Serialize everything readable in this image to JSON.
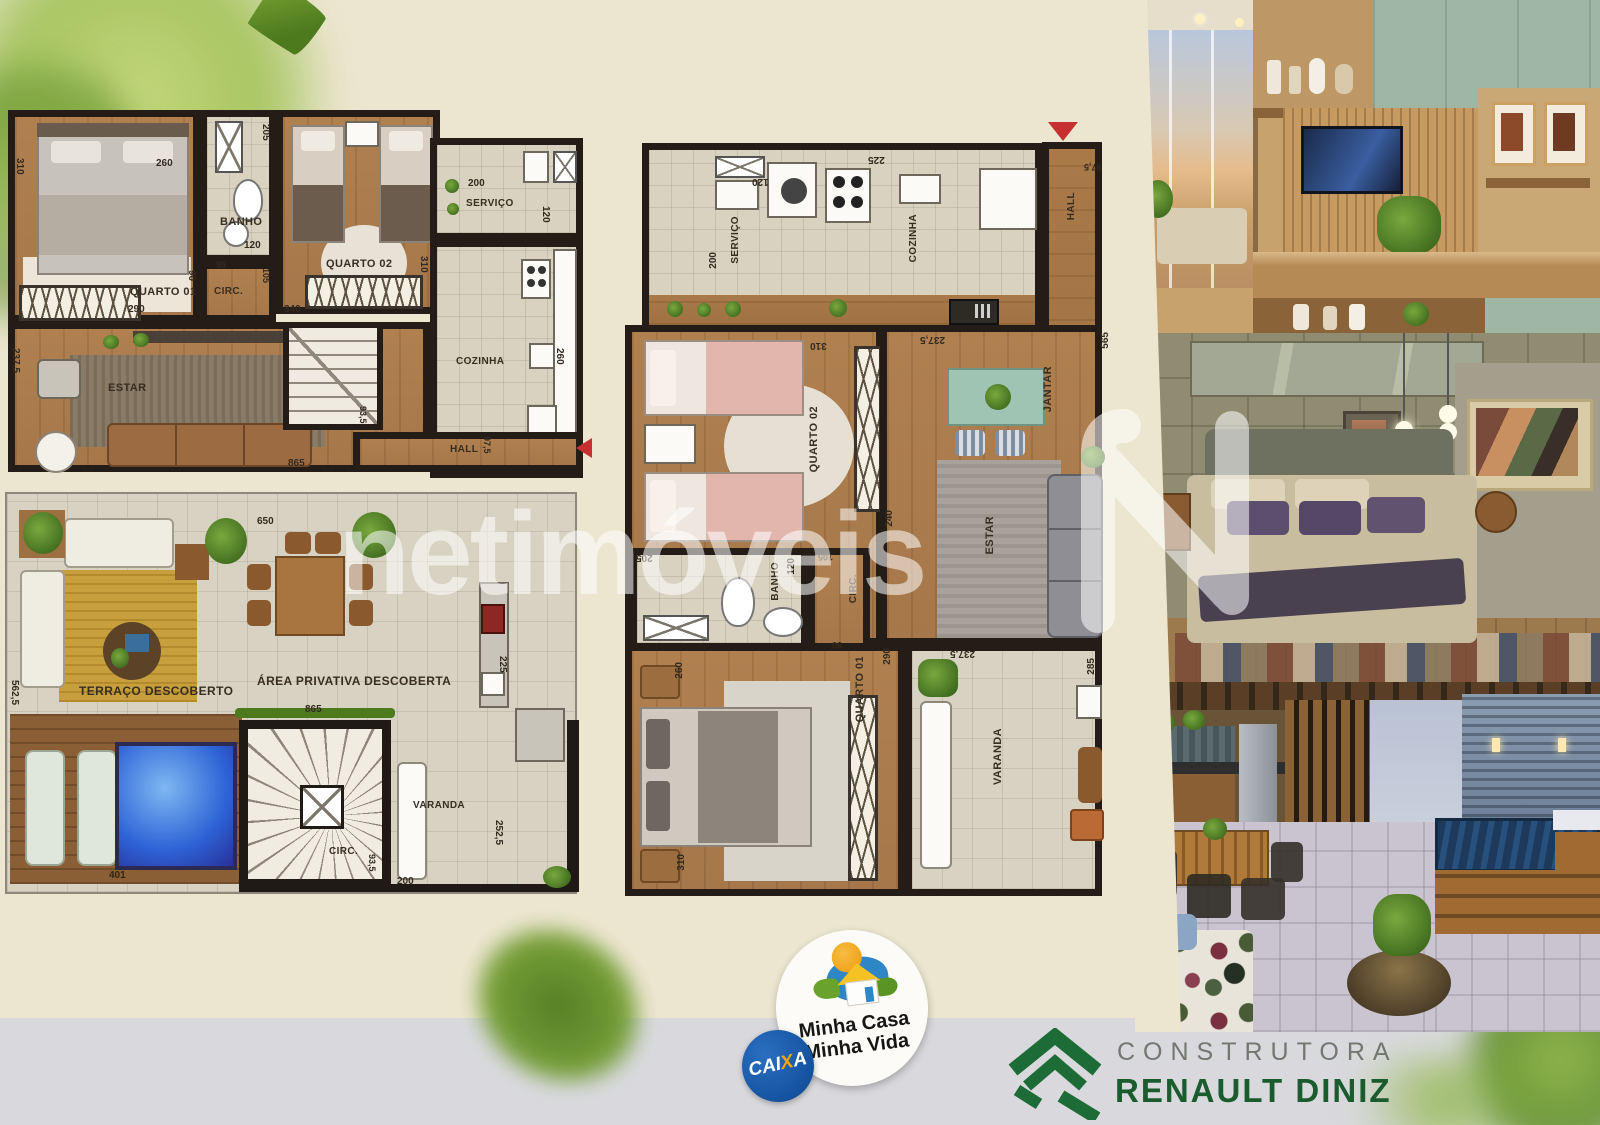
{
  "watermark": {
    "text": "netimóveis"
  },
  "plan_upper": {
    "rooms": {
      "quarto01": "QUARTO 01",
      "banho": "BANHO",
      "circ": "CIRC.",
      "quarto02": "QUARTO 02",
      "servico": "SERVIÇO",
      "cozinha": "COZINHA",
      "estar": "ESTAR",
      "hall": "HALL"
    },
    "dims": {
      "q1_h": "310",
      "bed_w": "260",
      "q1_w": "290",
      "q1_door": "90",
      "banho_l": "205",
      "banho_w": "120",
      "d95": "95",
      "d105": "105",
      "q2_h": "310",
      "q2_w": "340",
      "serv_w": "200",
      "serv_d": "120",
      "coz_d": "260",
      "estar_d": "237,5",
      "total": "865",
      "hall_a": "93,5",
      "hall_b": "97,5"
    }
  },
  "plan_terrace": {
    "rooms": {
      "terraco": "TERRAÇO DESCOBERTO",
      "area": "ÁREA PRIVATIVA DESCOBERTA",
      "varanda": "VARANDA",
      "circ": "CIRC."
    },
    "dims": {
      "top": "650",
      "inner": "865",
      "left": "562,5",
      "right": "225",
      "pool": "401",
      "varanda_r": "252,5",
      "stairs": "93,5",
      "door": "200"
    }
  },
  "plan_lower": {
    "rooms": {
      "servico": "SERVIÇO",
      "cozinha": "COZINHA",
      "hall": "HALL",
      "quarto02": "QUARTO 02",
      "jantar": "JANTAR",
      "estar": "ESTAR",
      "banho": "BANHO",
      "circ": "CIRC.",
      "quarto01": "QUARTO 01",
      "varanda": "VARANDA"
    },
    "dims": {
      "serv_h": "200",
      "serv_w": "120",
      "sink": "225",
      "hall_w": "97,5",
      "side": "565",
      "jantar_w": "237,5",
      "q2_top": "310",
      "q2_side": "240",
      "banho_l": "205",
      "banho_w": "120",
      "circ_a": "105",
      "circ_b": "90",
      "q1_side": "290",
      "q1_head": "260",
      "q1_bottom": "310",
      "var_top": "237,5",
      "var_side": "285"
    }
  },
  "badges": {
    "mcmv_line1": "Minha Casa",
    "mcmv_line2": "Minha Vida",
    "caixa_p1": "CAI",
    "caixa_x": "X",
    "caixa_p2": "A",
    "builder_top": "CONSTRUTORA",
    "builder_name": "RENAULT DINIZ"
  },
  "colors": {
    "flyer_cream": "#ece6d0",
    "band_gray": "#d9d9dd",
    "caixa_blue": "#14519d",
    "builder_green": "#1a5c2e",
    "builder_gray": "#72776f",
    "mcmv_blue": "#2e86c5",
    "mcmv_orange": "#f0a01c",
    "mcmv_green": "#6aa32c",
    "pool_blue": "#2e63d6",
    "wall_dark": "#241d17",
    "north_arrow_red": "#c63030"
  }
}
